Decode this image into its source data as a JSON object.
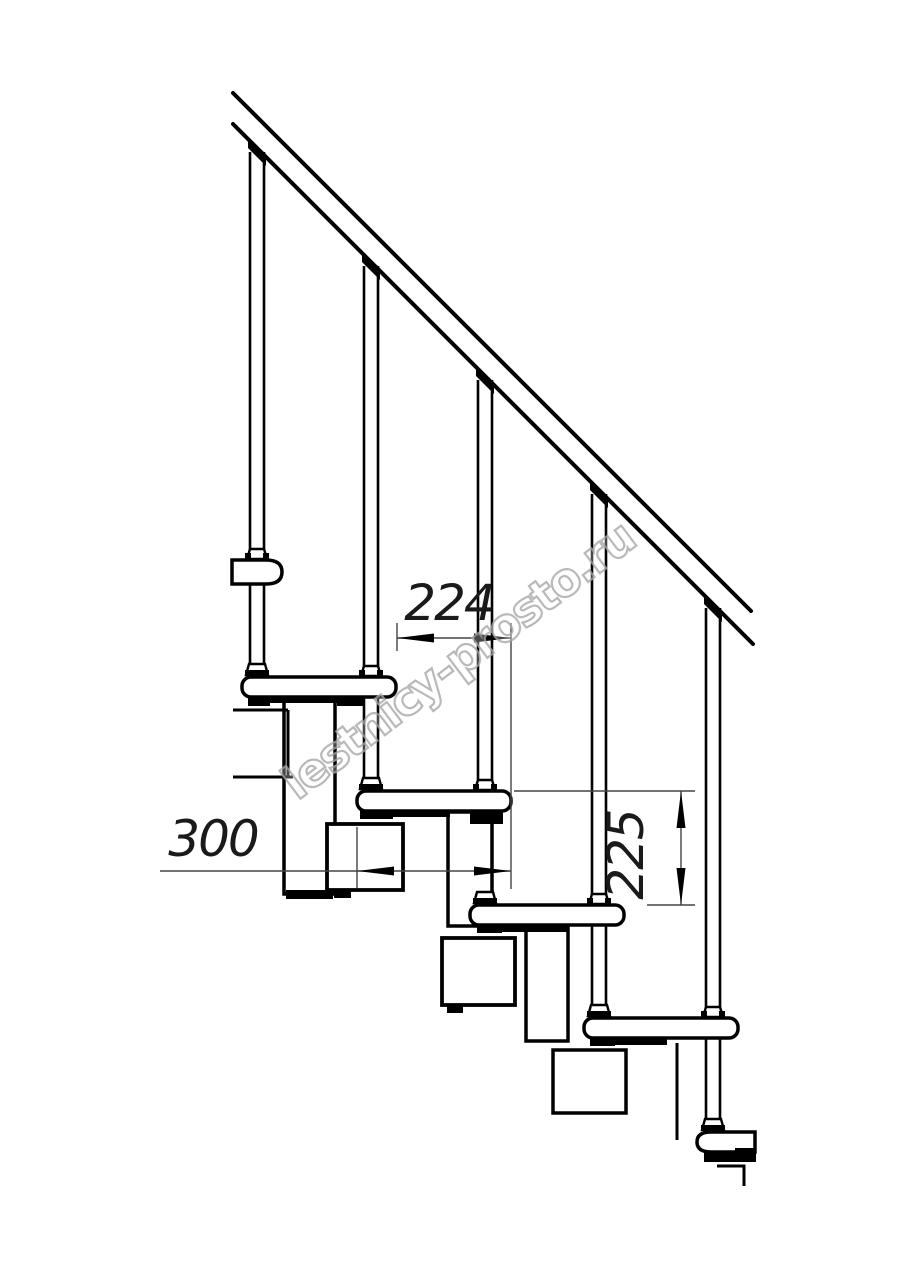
{
  "drawing": {
    "type": "staircase-side-elevation-blueprint",
    "colors": {
      "background": "#ffffff",
      "lines": "#000000",
      "watermark": "#a8a8a8"
    },
    "watermark": {
      "text": "lestnicy-prosto.ru"
    },
    "dimensions": {
      "step_run": {
        "label": "224"
      },
      "tread_depth": {
        "label": "300"
      },
      "step_rise": {
        "label": "225"
      }
    }
  }
}
